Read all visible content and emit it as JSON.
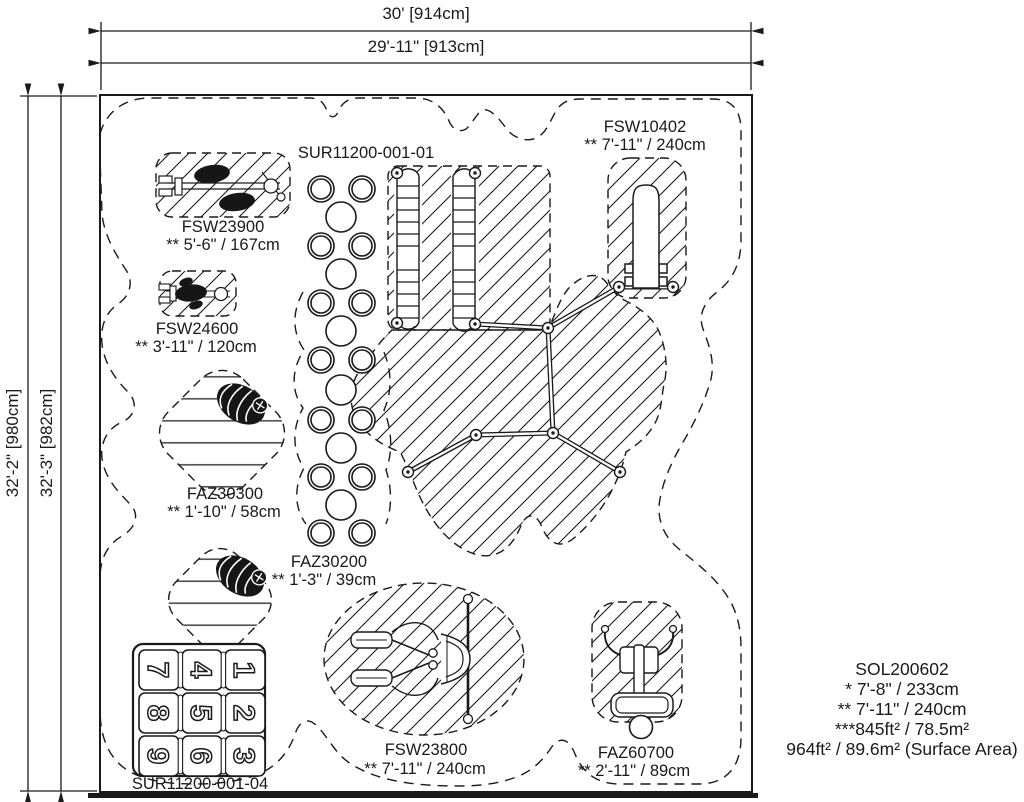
{
  "colors": {
    "line": "#1a1a1a",
    "background": "#ffffff"
  },
  "dimensions": {
    "top_outer": "30' [914cm]",
    "top_inner": "29'-11\" [913cm]",
    "left_outer": "32'-2\" [980cm]",
    "left_inner": "32'-3\" [982cm]"
  },
  "surfacing": {
    "top_label": "SUR11200-001-01",
    "bottom_label": "SUR11200-001-04"
  },
  "equipment": {
    "fsw23900": {
      "code": "FSW23900",
      "spec": "** 5'-6\" / 167cm"
    },
    "fsw10402": {
      "code": "FSW10402",
      "spec": "** 7'-11\" / 240cm"
    },
    "fsw24600": {
      "code": "FSW24600",
      "spec": "** 3'-11\" / 120cm"
    },
    "faz30300": {
      "code": "FAZ30300",
      "spec": "** 1'-10\" / 58cm"
    },
    "faz30200": {
      "code": "FAZ30200",
      "spec": "** 1'-3\" / 39cm"
    },
    "fsw23800": {
      "code": "FSW23800",
      "spec": "** 7'-11\" / 240cm"
    },
    "faz60700": {
      "code": "FAZ60700",
      "spec": "** 2'-11\" / 89cm"
    }
  },
  "summary": {
    "model": "SOL200602",
    "line1": "* 7'-8\" / 233cm",
    "line2": "** 7'-11\" / 240cm",
    "line3": "***845ft² / 78.5m²",
    "line4": "964ft² / 89.6m² (Surface Area)"
  },
  "hopscotch": {
    "numbers": [
      "7",
      "4",
      "1",
      "8",
      "5",
      "2",
      "9",
      "6",
      "3"
    ]
  }
}
